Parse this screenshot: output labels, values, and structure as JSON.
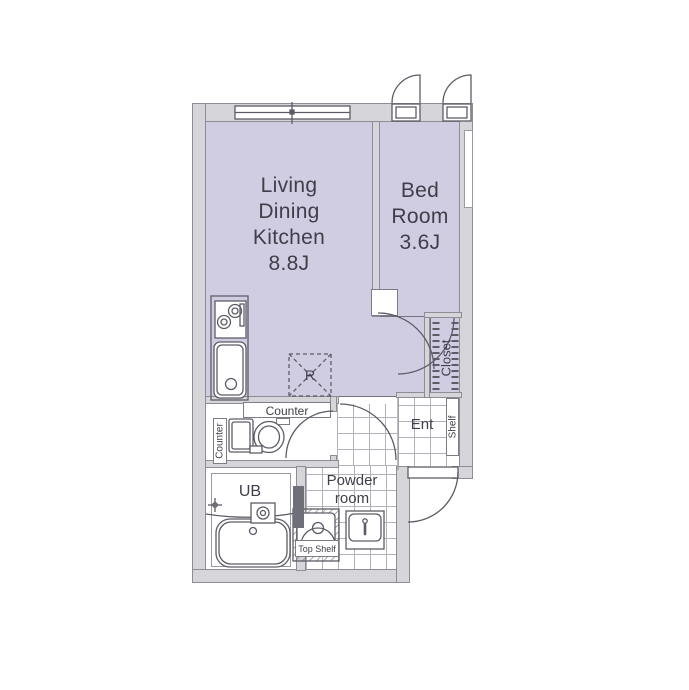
{
  "title": "1K apartment floor plan",
  "rooms": {
    "ldk": "Living\nDining\nKitchen\n8.8J",
    "bedroom": "Bed\nRoom\n3.6J",
    "closet": "Closet",
    "entrance": "Ent",
    "shelf": "Shelf",
    "counter_top": "Counter",
    "counter_side": "Counter",
    "unit_bath": "UB",
    "powder_room": "Powder\nroom",
    "top_shelf": "Top Shelf",
    "refrigerator": "R"
  },
  "colors": {
    "room_fill": "#d0cde3",
    "wall_fill": "#d6d5d9",
    "wall_outline": "#8d8d95",
    "fixture_line": "#5c5c66",
    "text": "#3f3e49",
    "tile_line": "#b2b2ba"
  }
}
